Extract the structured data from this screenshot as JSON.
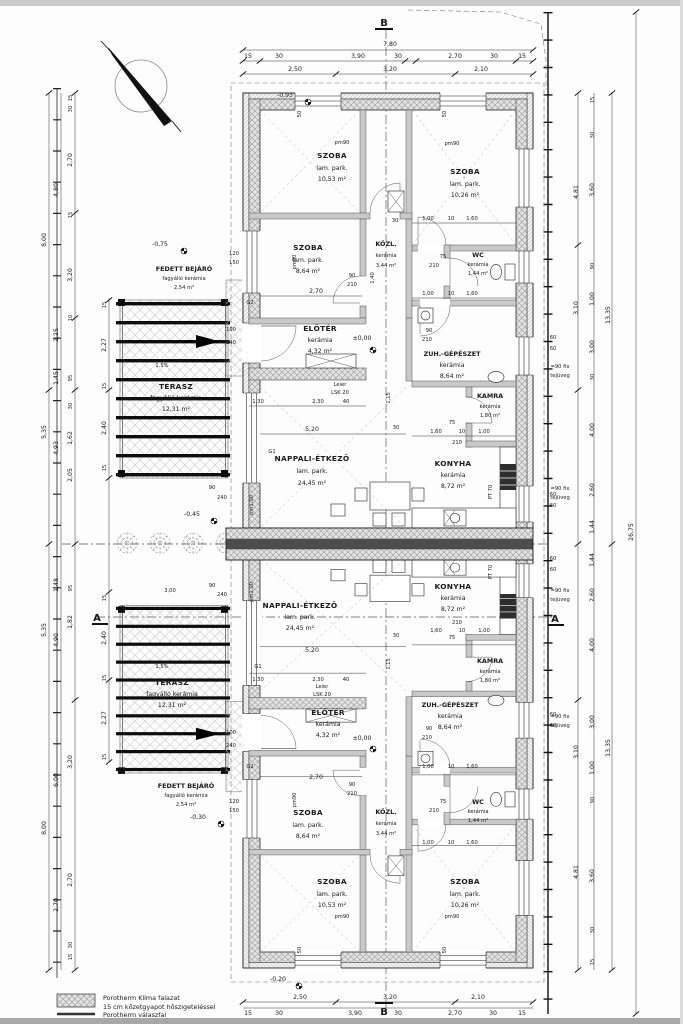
{
  "sections": {
    "a": "A",
    "b": "B"
  },
  "legend": {
    "wall_line1": "Porotherm Klíma falazat",
    "wall_line2": "15 cm kőzetgyapot hőszigeteléssel",
    "partition_line": "Porotherm válaszfal"
  },
  "levels": {
    "m093": "-0,93",
    "m075": "-0,75",
    "zero": "±0,00",
    "m045": "-0,45",
    "m030": "-0,30",
    "m020": "-0,20"
  },
  "rooms": [
    {
      "name": "SZOBA",
      "floor": "lam. park.",
      "area": "10,53 m²"
    },
    {
      "name": "SZOBA",
      "floor": "lam. park.",
      "area": "10,26 m²"
    },
    {
      "name": "SZOBA",
      "floor": "lam. park.",
      "area": "8,64 m²"
    },
    {
      "name": "KÖZL.",
      "floor": "kerámia",
      "area": "3,44 m²"
    },
    {
      "name": "WC",
      "floor": "kerámia",
      "area": "1,44 m²"
    },
    {
      "name": "ELŐTÉR",
      "floor": "kerámia",
      "area": "4,32 m²"
    },
    {
      "name": "ZUH.-GÉPÉSZET",
      "floor": "kerámia",
      "area": "8,64 m²"
    },
    {
      "name": "KAMRA",
      "floor": "kerámia",
      "area": "1,80 m²"
    },
    {
      "name": "NAPPALI-ÉTKEZŐ",
      "floor": "lam. park.",
      "area": "24,45 m²"
    },
    {
      "name": "KONYHA",
      "floor": "kerámia",
      "area": "8,72 m²"
    },
    {
      "name": "TERASZ",
      "floor": "fagyálló kerámia",
      "area": "12,31 m²"
    },
    {
      "name": "FEDETT BEJÁRÓ",
      "floor": "fagyálló kerámia",
      "area": "2,54 m²"
    }
  ],
  "notes": {
    "fix1": "=90 fix",
    "fix2": "tejüveg",
    "lintel1": "Leier",
    "lintel2": "LSK 20",
    "slope": "1,5%",
    "g1": "G1",
    "g2": "G2",
    "pm90": "pm90",
    "pm100": "pm1,00",
    "pt70": "PT 70"
  },
  "tags": {
    "t15": "15",
    "t30": "30",
    "t10": "10",
    "t40": "40",
    "t50": "50",
    "t60": "60",
    "t75": "75",
    "t90": "90",
    "t95": "95",
    "t100": "100",
    "t120": "120",
    "t150": "150",
    "t210": "210",
    "t240": "240"
  },
  "dims": {
    "overall_w": "7,80",
    "overall_h": "26,75",
    "unit_h": "13,35",
    "top1": [
      "15",
      "30",
      "3,90",
      "30",
      "2,70",
      "30",
      "15"
    ],
    "top2": [
      "2,50",
      "3,20",
      "2,10"
    ],
    "l800": "8,00",
    "l535": "5,35",
    "l493": "4,93",
    "l480": "4,80",
    "l225": "2,25",
    "l145": "1,45",
    "l162": "1,62",
    "l205": "2,05",
    "l148": "1,48",
    "l227": "2,27",
    "l240": "2,40",
    "l270": "2,70",
    "l320": "3,20",
    "l490": "4,90",
    "l600": "6,00",
    "l182": "1,82",
    "v481": "4,81",
    "v310": "3,10",
    "v360": "3,60",
    "v300": "3,00",
    "v100": "1,00",
    "v144": "1,44",
    "v400": "4,00",
    "v260": "2,60",
    "i520": "5,20",
    "i130": "1,30",
    "i230": "2,30",
    "i115": "1,15",
    "i140": "1,40",
    "i160": "1,60",
    "i270": "2,70"
  }
}
